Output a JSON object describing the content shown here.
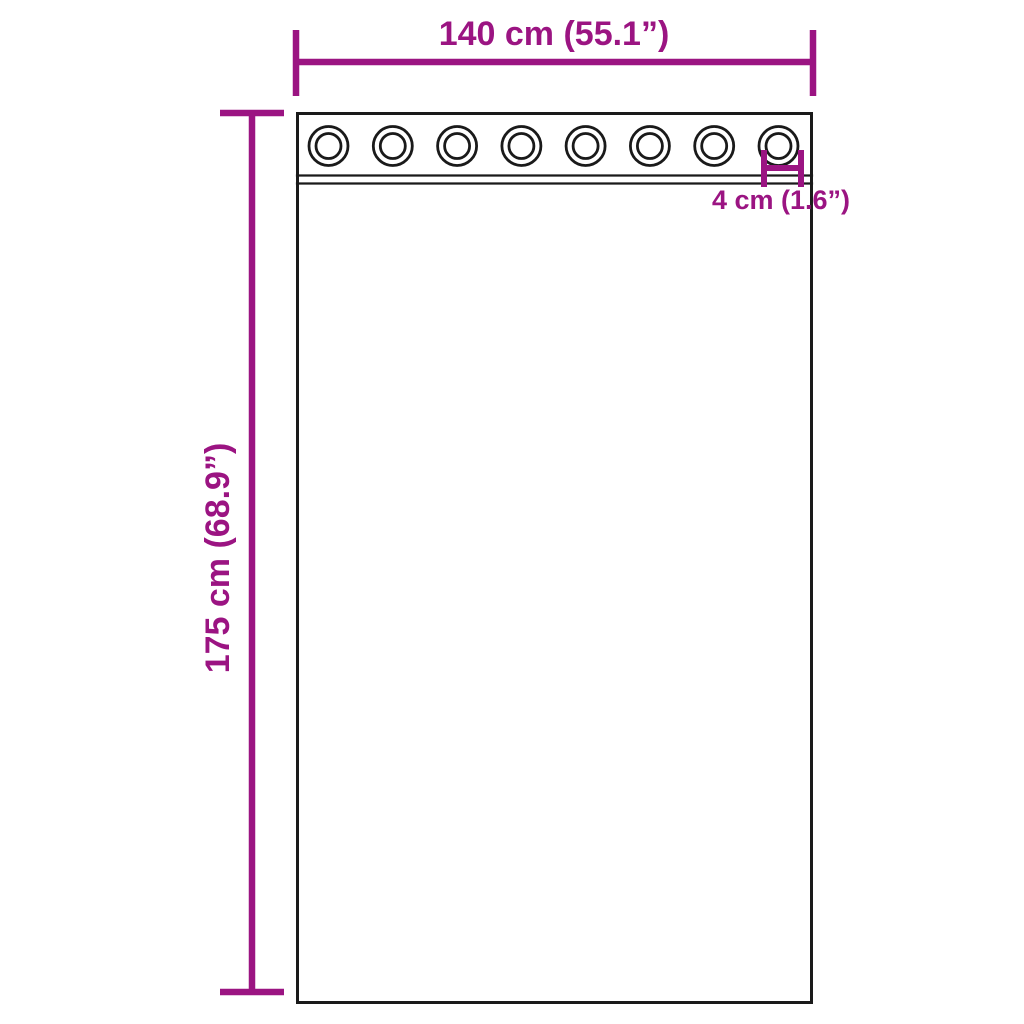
{
  "diagram": {
    "type": "curtain-with-grommets-dimension-diagram",
    "width_label": "140 cm (55.1”)",
    "height_label": "175 cm (68.9”)",
    "grommet_label": "4 cm (1.6”)",
    "grommet_count": 8,
    "colors": {
      "dimension": "#9B1482",
      "outline": "#1A1A1A",
      "background": "#FFFFFF"
    }
  }
}
